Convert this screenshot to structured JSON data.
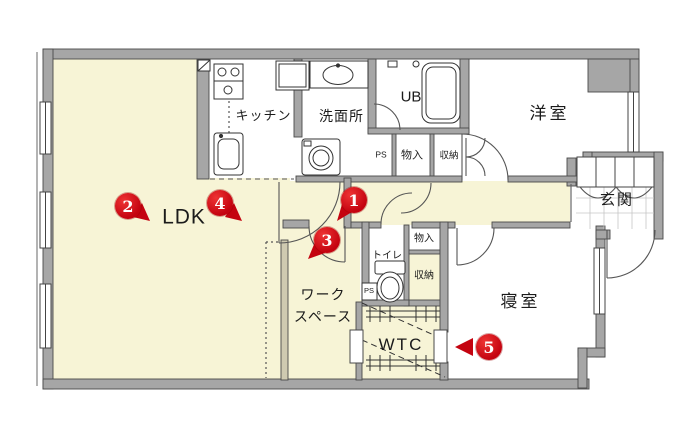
{
  "title": "apartment-floor-plan",
  "colors": {
    "floor_yellow": "#f7f4d6",
    "wall_gray": "#a6a6a6",
    "wall_edge": "#4a4a4a",
    "marker_red": "#c40310",
    "line": "#3c3c3c"
  },
  "rooms": {
    "ldk": {
      "label": "LDK"
    },
    "kitchen": {
      "label": "キッチン"
    },
    "washroom": {
      "label": "洗面所"
    },
    "unit_bath": {
      "label": "UB"
    },
    "western_room": {
      "label": "洋室"
    },
    "entrance": {
      "label": "玄関"
    },
    "toilet": {
      "label": "トイレ"
    },
    "workspace": {
      "label": "ワーク\nスペース"
    },
    "walk_through_closet": {
      "label": "WTC"
    },
    "bedroom": {
      "label": "寝室"
    },
    "pipe_space_upper": {
      "label": "PS"
    },
    "storage_upper": {
      "label": "物入"
    },
    "closet_upper": {
      "label": "収納"
    },
    "storage_hall": {
      "label": "物入"
    },
    "closet_hall": {
      "label": "収納"
    },
    "pipe_space_toilet": {
      "label": "PS"
    }
  },
  "markers": [
    {
      "number": "1"
    },
    {
      "number": "2"
    },
    {
      "number": "3"
    },
    {
      "number": "4"
    },
    {
      "number": "5"
    }
  ]
}
